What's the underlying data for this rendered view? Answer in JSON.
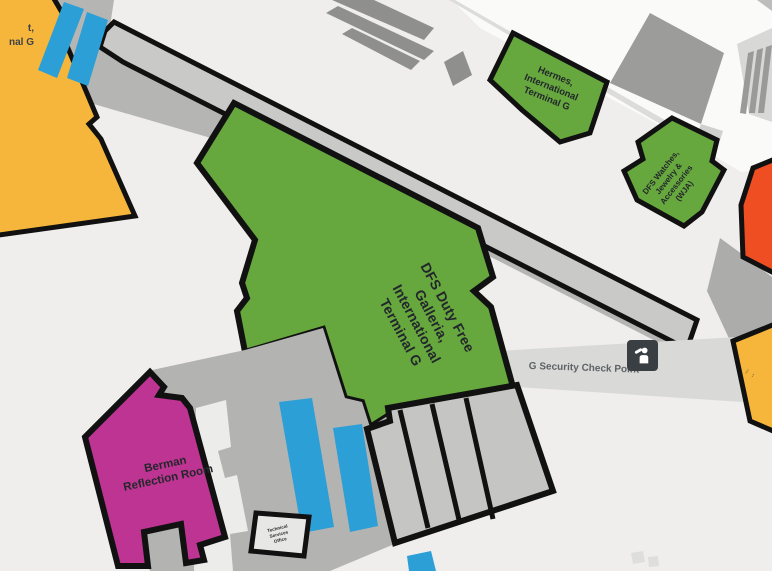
{
  "map_labels": {
    "dfs_galleria": {
      "lines": [
        "DFS Duty Free",
        "Galleria,",
        "International",
        "Terminal G"
      ]
    },
    "hermes": {
      "lines": [
        "Hermes,",
        "International",
        "Terminal G"
      ]
    },
    "dfs_watches": {
      "lines": [
        "DFS Watches,",
        "Jewelry &",
        "Accessories",
        "(WJA)"
      ]
    },
    "berman": {
      "lines": [
        "Berman",
        "Reflection Room"
      ]
    },
    "security": {
      "label": "G Security Check Point"
    },
    "technical_room": {
      "lines": [
        "Technical",
        "Services",
        "Office"
      ]
    },
    "edge_left_partial": {
      "lines": [
        "t,",
        "nal G"
      ]
    },
    "edge_right_partial": {
      "lines": [
        "···",
        "··"
      ]
    }
  },
  "icons": {
    "security_checkpoint": "security-officer-icon"
  },
  "colors": {
    "shop_green": "#66A73E",
    "gate_yellow": "#F6B63C",
    "poi_magenta": "#BE3492",
    "alert_orange": "#EF4E23",
    "transit_blue": "#2B9FD6",
    "outline_black": "#111111",
    "concourse_gray": "#B5B5B4",
    "security_band_gray": "#D9D9D7",
    "background": "#EFEEEC"
  }
}
